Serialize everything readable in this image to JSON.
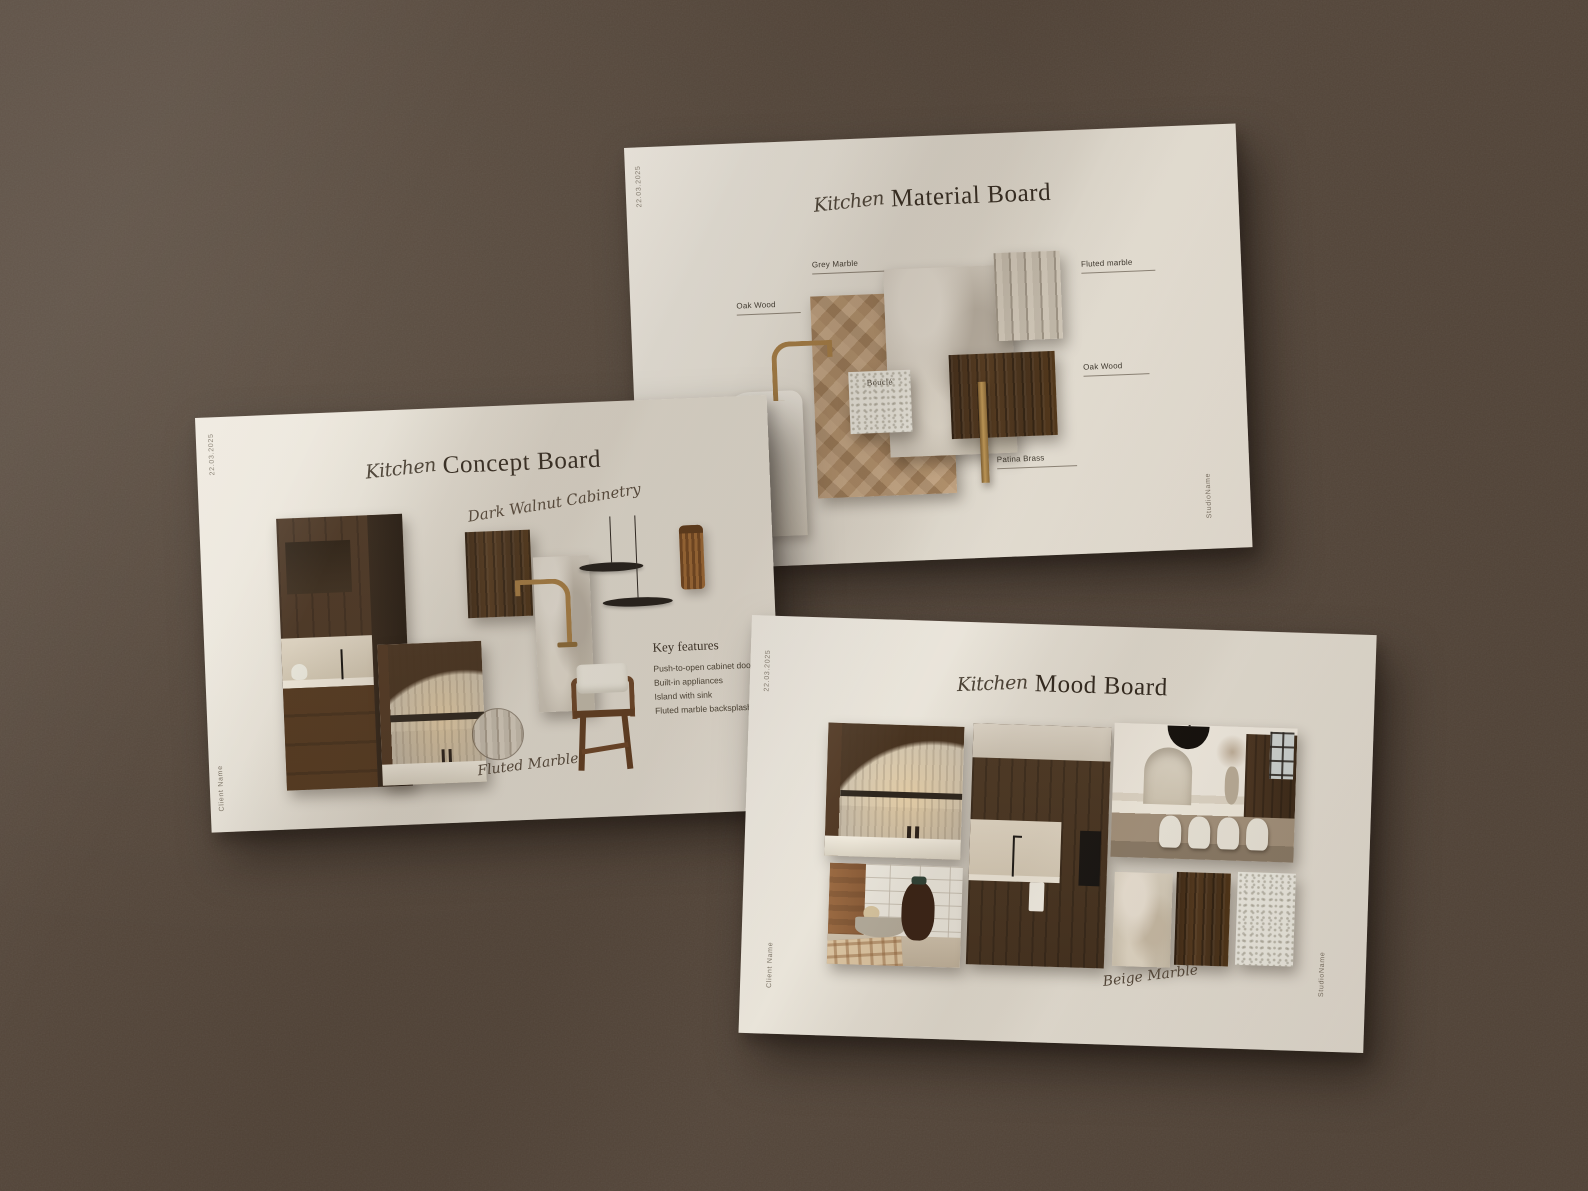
{
  "scene": {
    "surface_color": "#54463a",
    "card_color": "#e9e4d9"
  },
  "material_board": {
    "edge_date": "22.03.2025",
    "edge_studio": "StudioName",
    "title_script": "Kitchen",
    "title_main": "Material Board",
    "labels": {
      "grey_marble": "Grey Marble",
      "oak_wood_left": "Oak Wood",
      "fluted_marble": "Fluted marble",
      "oak_wood_right": "Oak Wood",
      "patina_brass": "Patina Brass",
      "boucle": "Bouclé"
    }
  },
  "concept_board": {
    "edge_date": "22.03.2025",
    "edge_client": "Client Name",
    "title_script": "Kitchen",
    "title_main": "Concept Board",
    "annotation_cabinetry": "Dark Walnut Cabinetry",
    "annotation_fluted": "Fluted Marble",
    "key_features": {
      "heading": "Key features",
      "items": [
        "Push-to-open cabinet doors",
        "Built-in appliances",
        "Island with sink",
        "Fluted marble backsplash"
      ]
    }
  },
  "mood_board": {
    "edge_date": "22.03.2025",
    "edge_client": "Client Name",
    "edge_studio": "StudioName",
    "title_script": "Kitchen",
    "title_main": "Mood Board",
    "annotation_beige": "Beige Marble"
  },
  "palette": {
    "walnut": "#4a3019",
    "oak": "#ab8760",
    "brass": "#a97f46",
    "grey_marble": "#cfc8bd",
    "boucle": "#edebe2",
    "ink": "#32291f",
    "script_ink": "#55483a"
  }
}
